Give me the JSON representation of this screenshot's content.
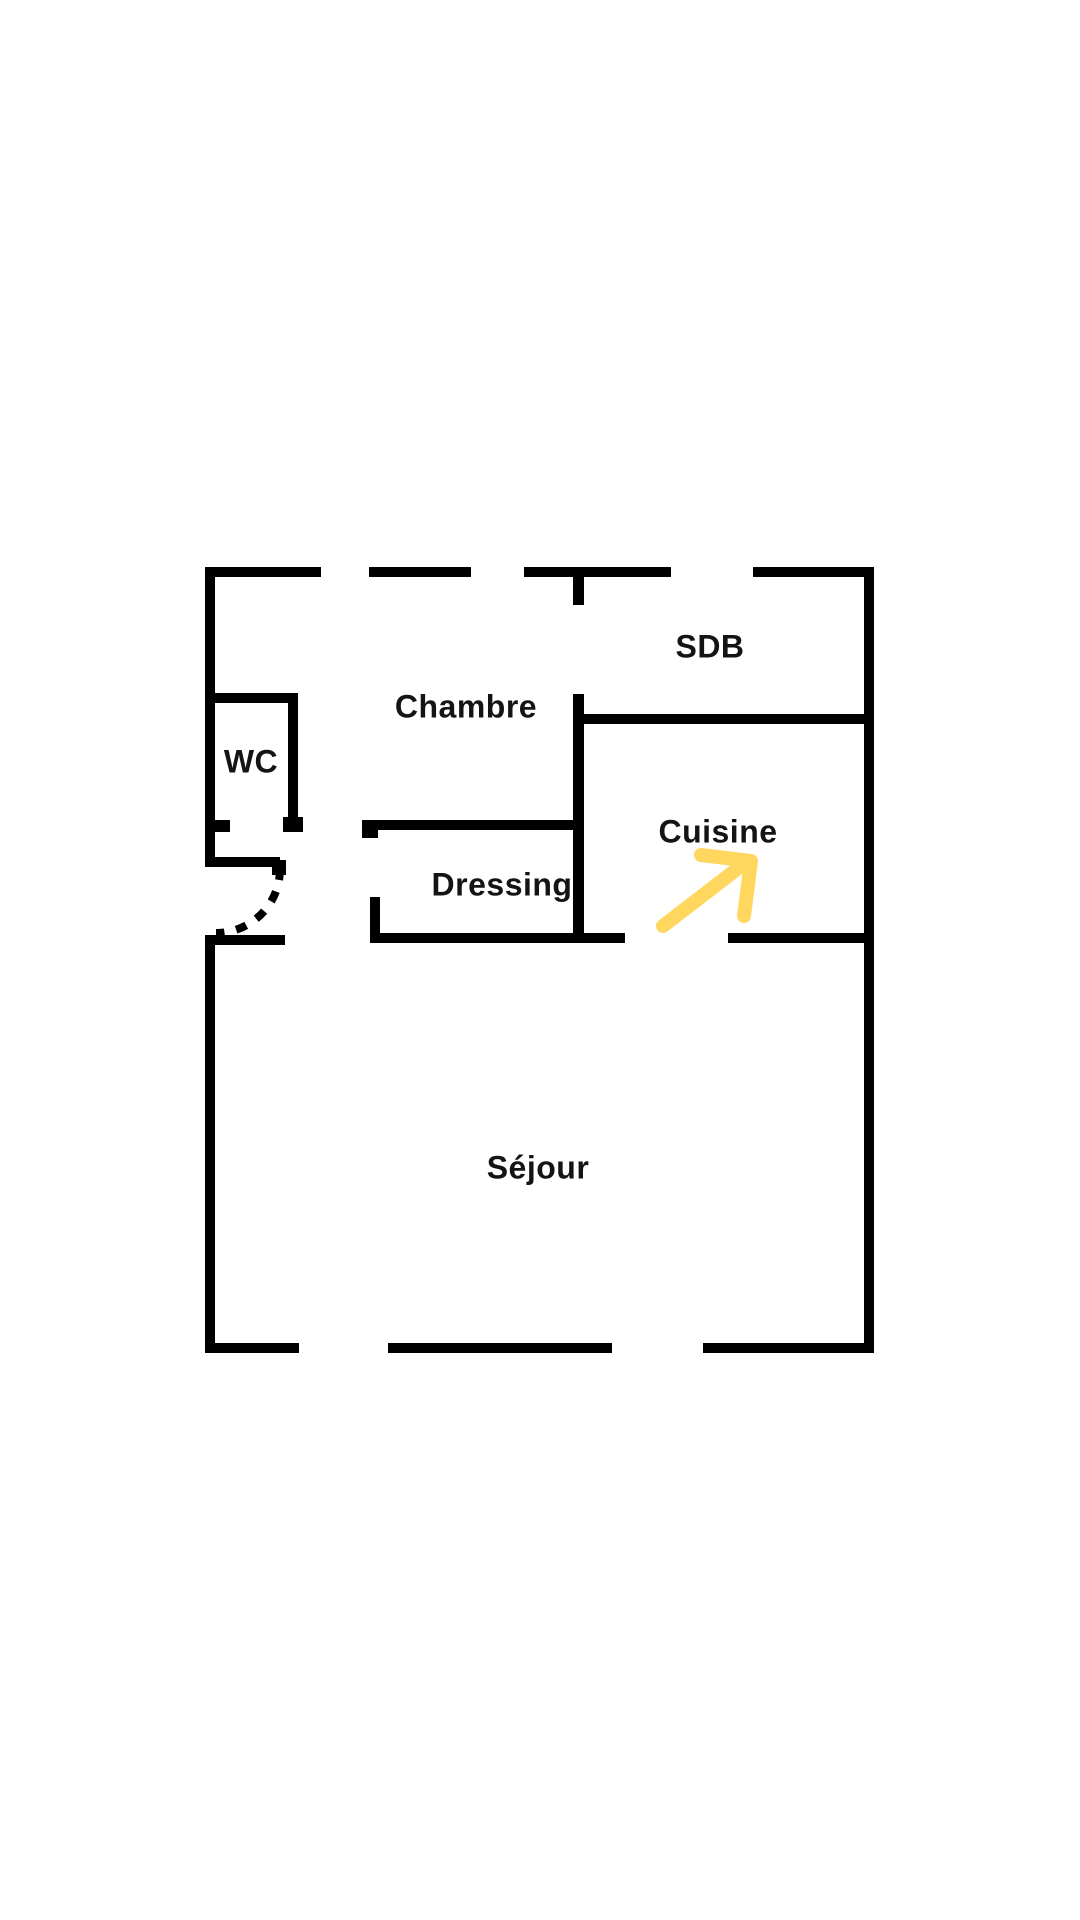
{
  "figure": {
    "type": "floor-plan",
    "background_color": "#ffffff",
    "wall_color": "#000000",
    "label_color": "#141414"
  },
  "rooms": [
    {
      "id": "sdb",
      "name": "SDB"
    },
    {
      "id": "chambre",
      "name": "Chambre"
    },
    {
      "id": "wc",
      "name": "WC"
    },
    {
      "id": "cuisine",
      "name": "Cuisine"
    },
    {
      "id": "dressing",
      "name": "Dressing"
    },
    {
      "id": "sejour",
      "name": "Séjour"
    }
  ],
  "annotation_arrow": {
    "points_to": "Cuisine",
    "color": "#FFD75E"
  },
  "door_swing": {
    "style": "dashed-arc",
    "location": "entry-left-wall"
  }
}
